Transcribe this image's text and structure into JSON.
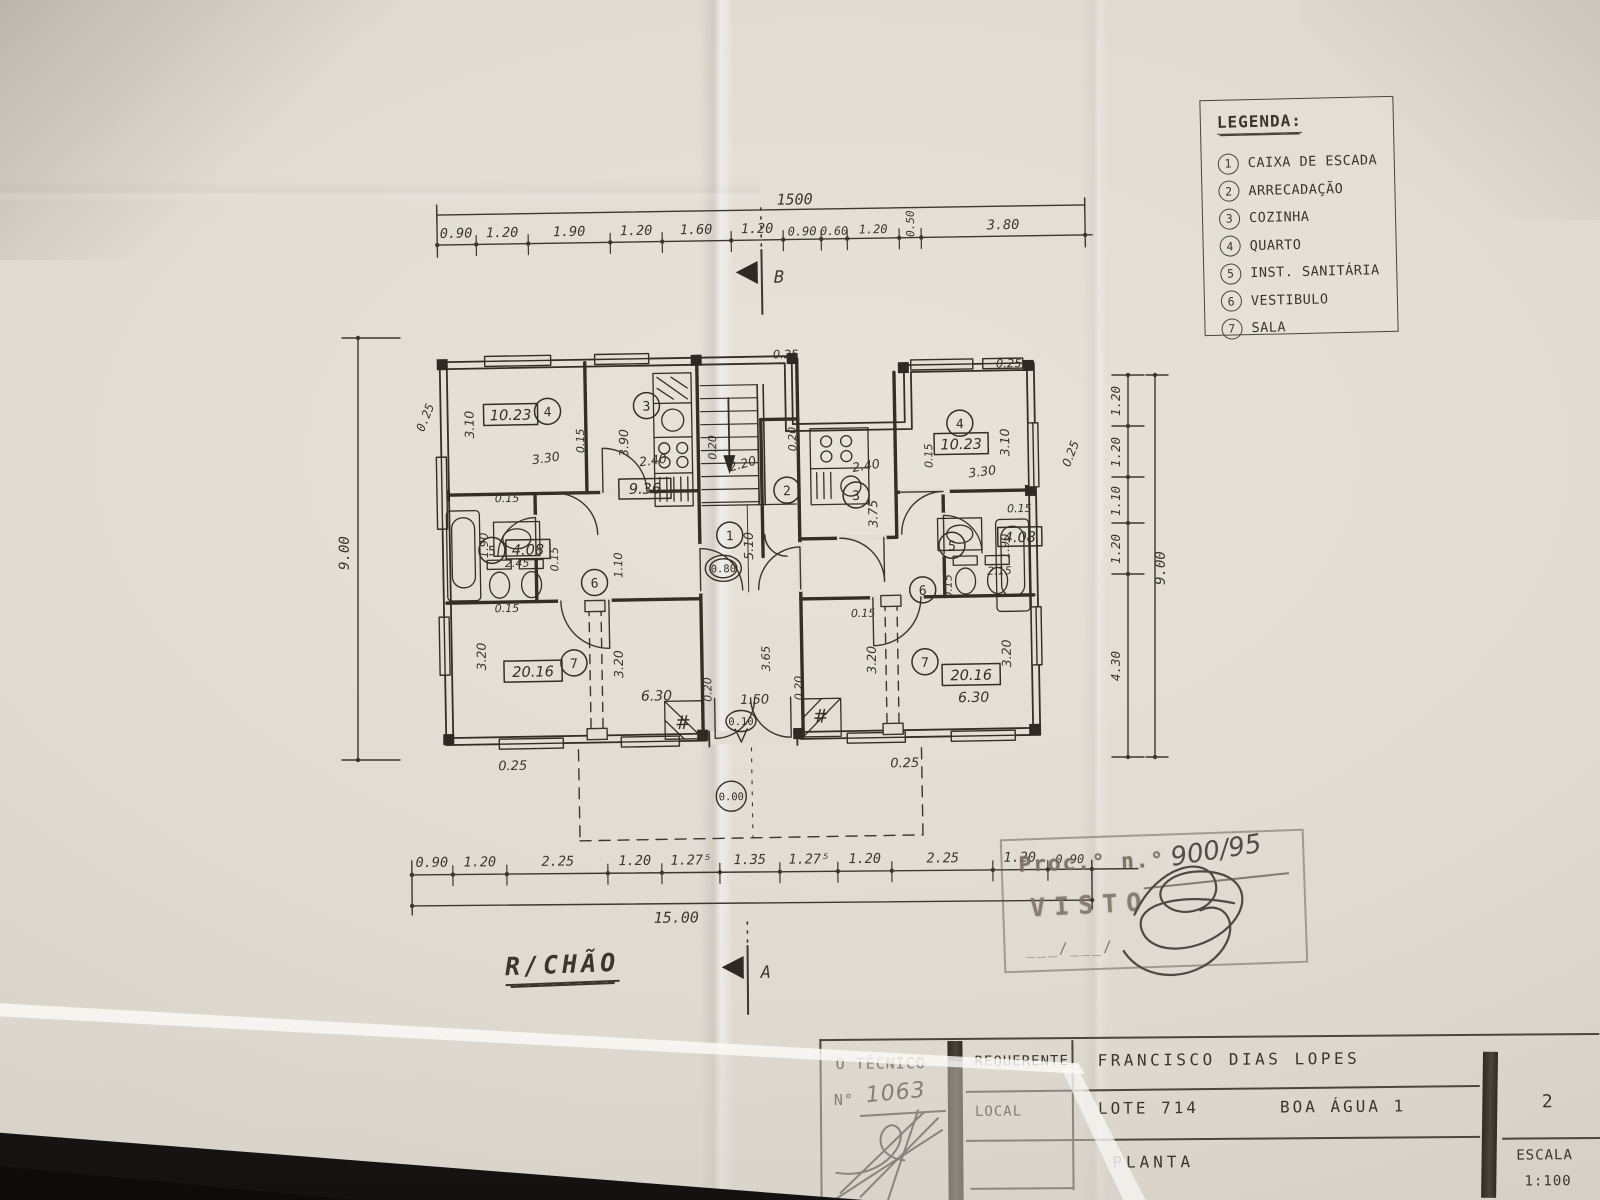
{
  "page": {
    "floor_label": "R/CHÃO"
  },
  "legend": {
    "title": "LEGENDA:",
    "items": [
      {
        "num": "1",
        "label": "CAIXA DE ESCADA"
      },
      {
        "num": "2",
        "label": "ARRECADAÇÃO"
      },
      {
        "num": "3",
        "label": "COZINHA"
      },
      {
        "num": "4",
        "label": "QUARTO"
      },
      {
        "num": "5",
        "label": "INST. SANITÁRIA"
      },
      {
        "num": "6",
        "label": "VESTIBULO"
      },
      {
        "num": "7",
        "label": "SALA"
      }
    ]
  },
  "dims": {
    "top": {
      "total": "1500",
      "segs": [
        "0.90",
        "1.20",
        "1.90",
        "1.20",
        "1.60",
        "1.20",
        "0.90",
        "0.60",
        "1.20",
        "0.50",
        "3.80"
      ]
    },
    "bottom": {
      "total": "15.00",
      "segs": [
        "0.90",
        "1.20",
        "2.25",
        "1.20",
        "1.27⁵",
        "1.35",
        "1.27⁵",
        "1.20",
        "2.25",
        "1.20",
        "0.90"
      ]
    },
    "left": {
      "total": "9.00",
      "wall": "0.25"
    },
    "right": {
      "total": "9.00",
      "segs": [
        "1.20",
        "1.20",
        "1.10",
        "1.20",
        "4.30"
      ]
    }
  },
  "sections": {
    "a": "A",
    "b": "B"
  },
  "plan": {
    "rooms": {
      "n1": "1",
      "n2": "2",
      "n3": "3",
      "n4": "4",
      "n5": "5",
      "n6": "6",
      "n7": "7"
    },
    "areas": {
      "quarto": "10.23",
      "cozinha": "9.36",
      "sanit": "4.08",
      "sala": "20.16"
    },
    "levels": {
      "l080": "0.80",
      "l010": "0.10",
      "l000": "0.00"
    },
    "hash": "#",
    "measures": {
      "w25": "0.25",
      "w20": "0.20",
      "w15": "0.15",
      "d310": "3.10",
      "d330": "3.30",
      "d390": "3.90",
      "d240": "2.40",
      "d220": "2.20",
      "d245": "2.45",
      "d215": "2.15",
      "d190": "1.90",
      "d110": "1.10",
      "d510": "5.10",
      "d150": "1.50",
      "d320": "3.20",
      "d630": "6.30",
      "d365": "3.65",
      "d375": "3.75"
    }
  },
  "stamp": {
    "proc": "Proc.° n.°",
    "number": "900/95",
    "visto": "VISTO",
    "date": "___/___/"
  },
  "title_block": {
    "tecnico_label": "O TÉCNICO",
    "no_label": "N°",
    "no_value": "1063",
    "requerente_label": "REQUERENTE",
    "requerente_value": "FRANCISCO DIAS LOPES",
    "local_label": "LOCAL",
    "local_value": "LOTE 714",
    "local_value2": "BOA ÁGUA 1",
    "drawing_label": "PLANTA",
    "sheet_number": "2",
    "scale_label": "ESCALA",
    "scale_value": "1:100"
  }
}
